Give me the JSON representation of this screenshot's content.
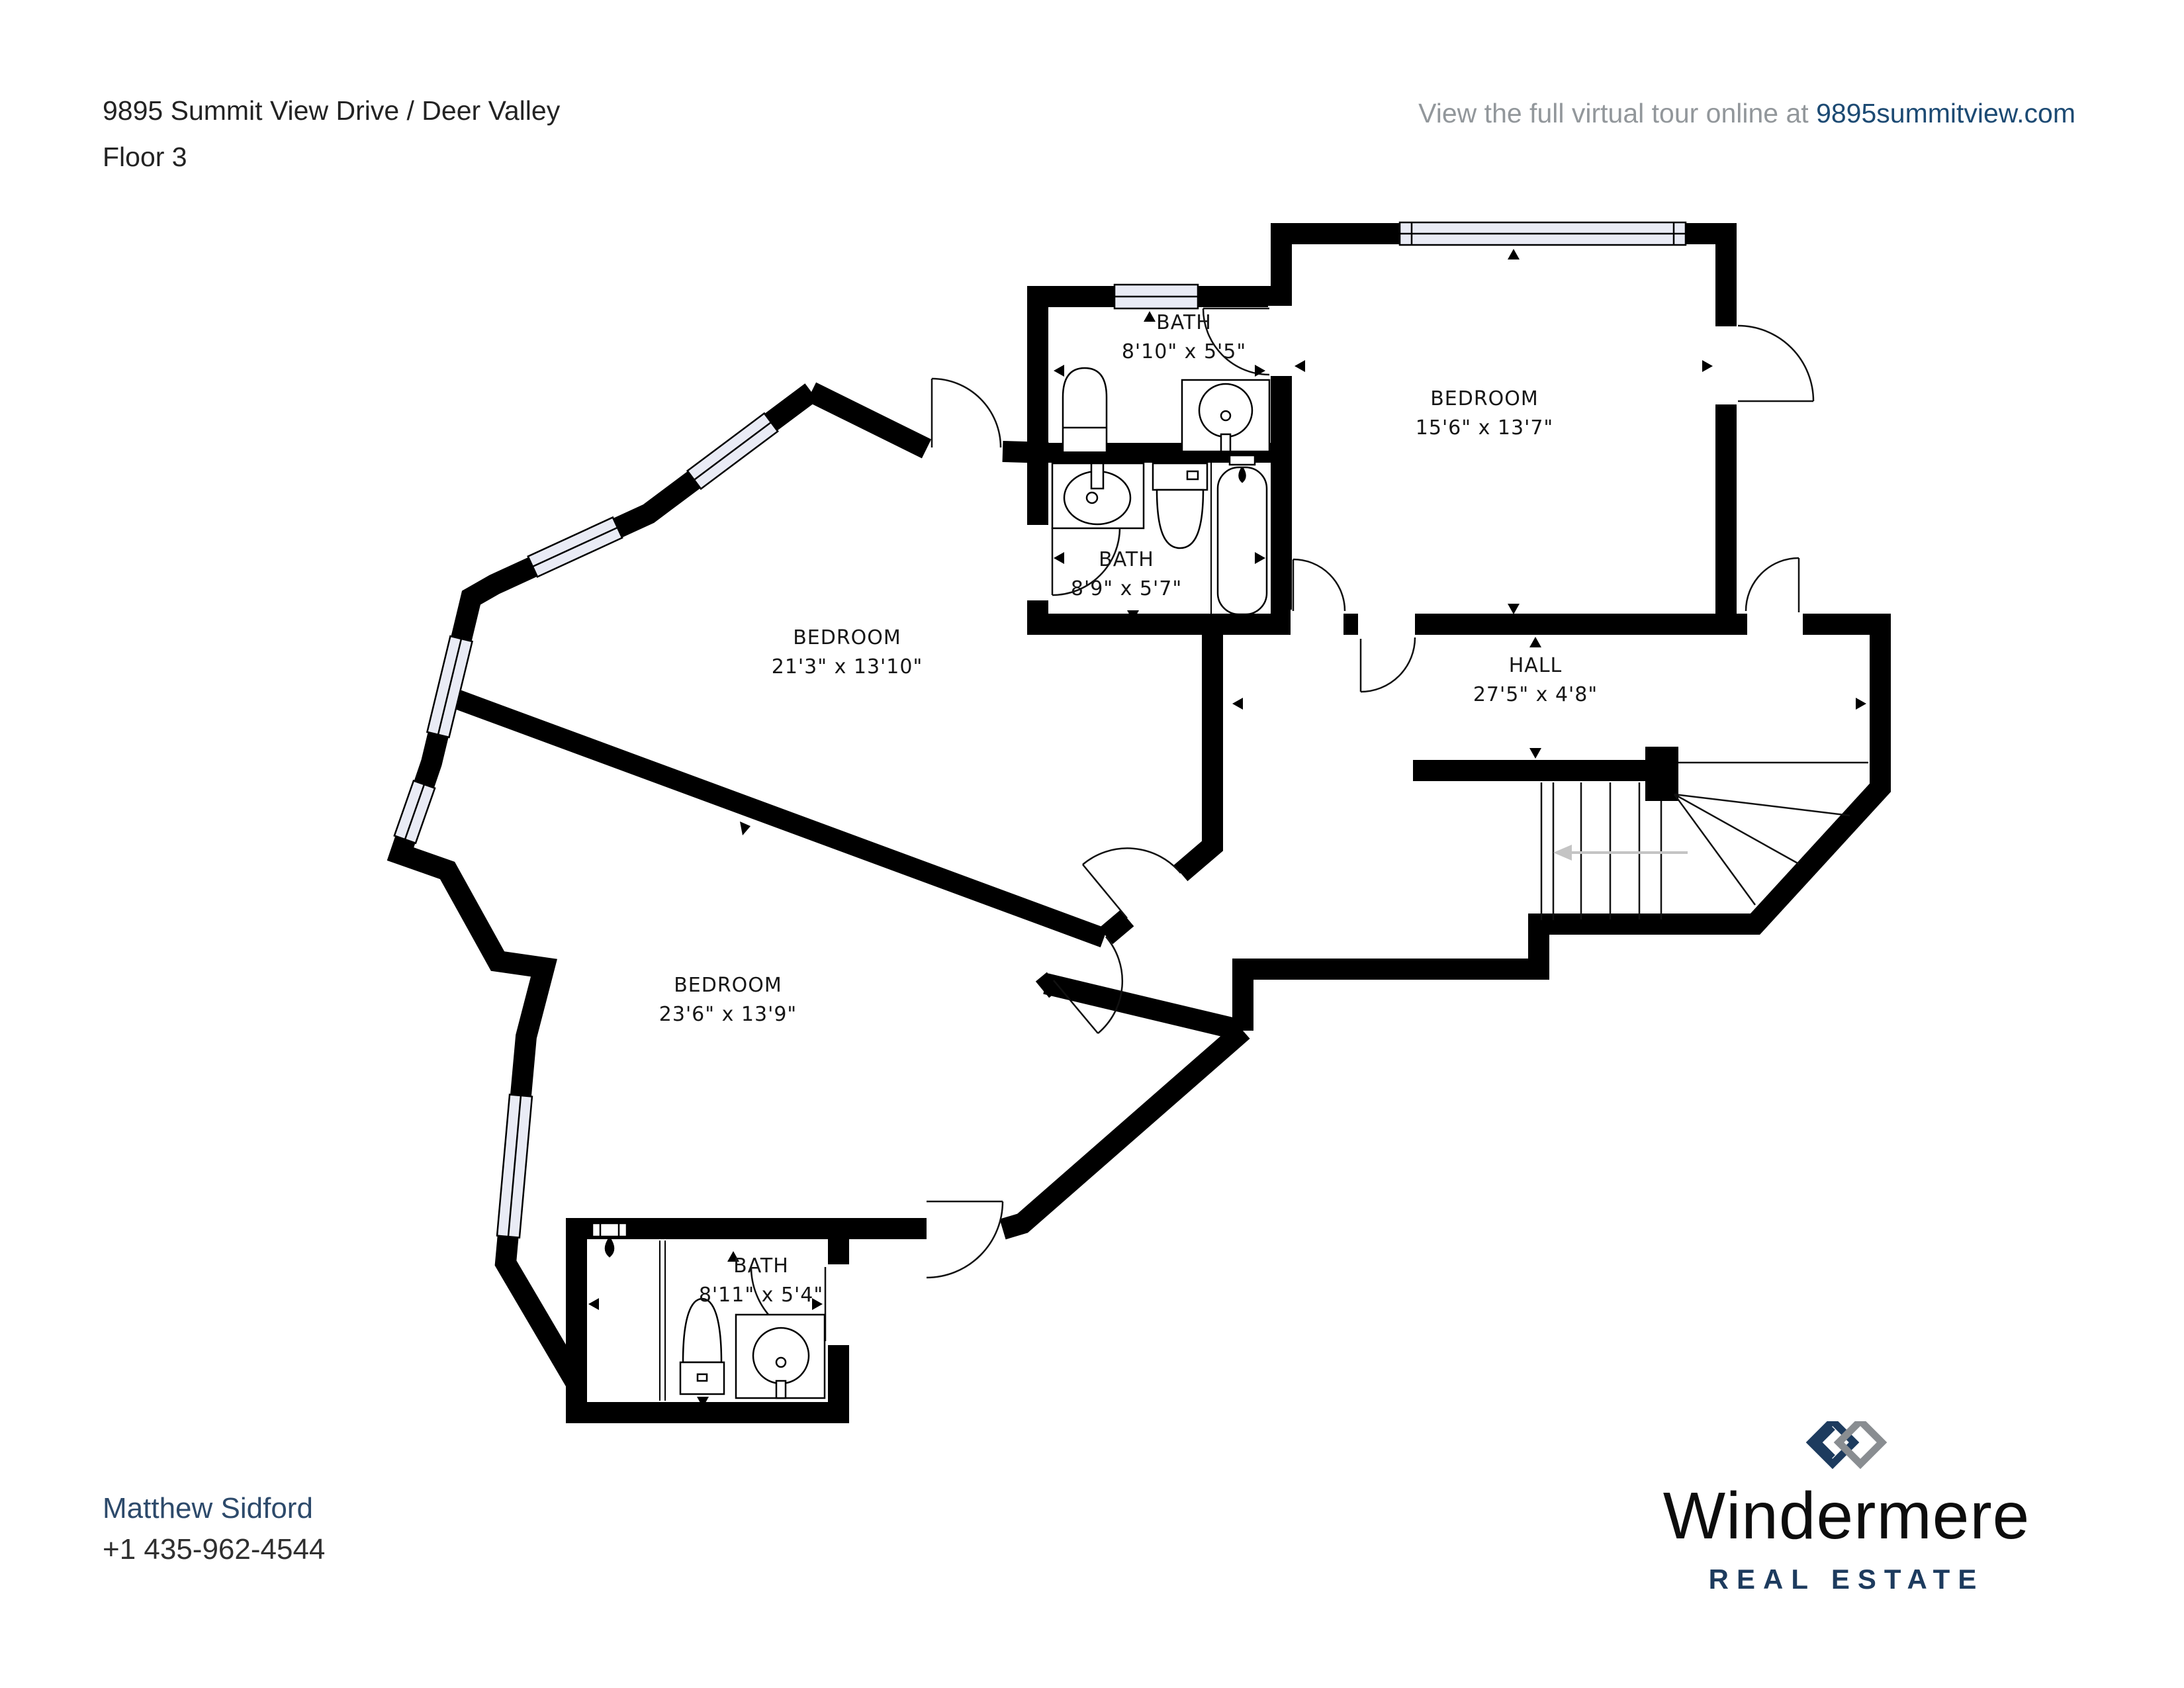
{
  "header": {
    "title": "9895 Summit View Drive / Deer Valley",
    "floor": "Floor 3"
  },
  "tour": {
    "prefix": "View the full virtual tour online at ",
    "link": "9895summitview.com"
  },
  "rooms": [
    {
      "id": "bath-top",
      "name": "BATH",
      "dims": "8'10\" x 5'5\""
    },
    {
      "id": "bedroom-ne",
      "name": "BEDROOM",
      "dims": "15'6\" x 13'7\""
    },
    {
      "id": "bath-middle",
      "name": "BATH",
      "dims": "8'9\" x 5'7\""
    },
    {
      "id": "bedroom-middle",
      "name": "BEDROOM",
      "dims": "21'3\" x 13'10\""
    },
    {
      "id": "hall",
      "name": "HALL",
      "dims": "27'5\" x 4'8\""
    },
    {
      "id": "bedroom-sw",
      "name": "BEDROOM",
      "dims": "23'6\" x 13'9\""
    },
    {
      "id": "bath-bottom",
      "name": "BATH",
      "dims": "8'11\" x 5'4\""
    }
  ],
  "agent": {
    "name": "Matthew Sidford",
    "phone": "+1 435-962-4544"
  },
  "brand": {
    "name": "Windermere",
    "tagline": "REAL ESTATE"
  },
  "colors": {
    "wall": "#000000",
    "window_glass": "#e9ebf5",
    "brand_navy": "#1d3b5e",
    "brand_gray": "#898d91",
    "link_navy": "#1c4a73",
    "muted_gray": "#92979b",
    "stair_arrow": "#c4c4c4"
  }
}
